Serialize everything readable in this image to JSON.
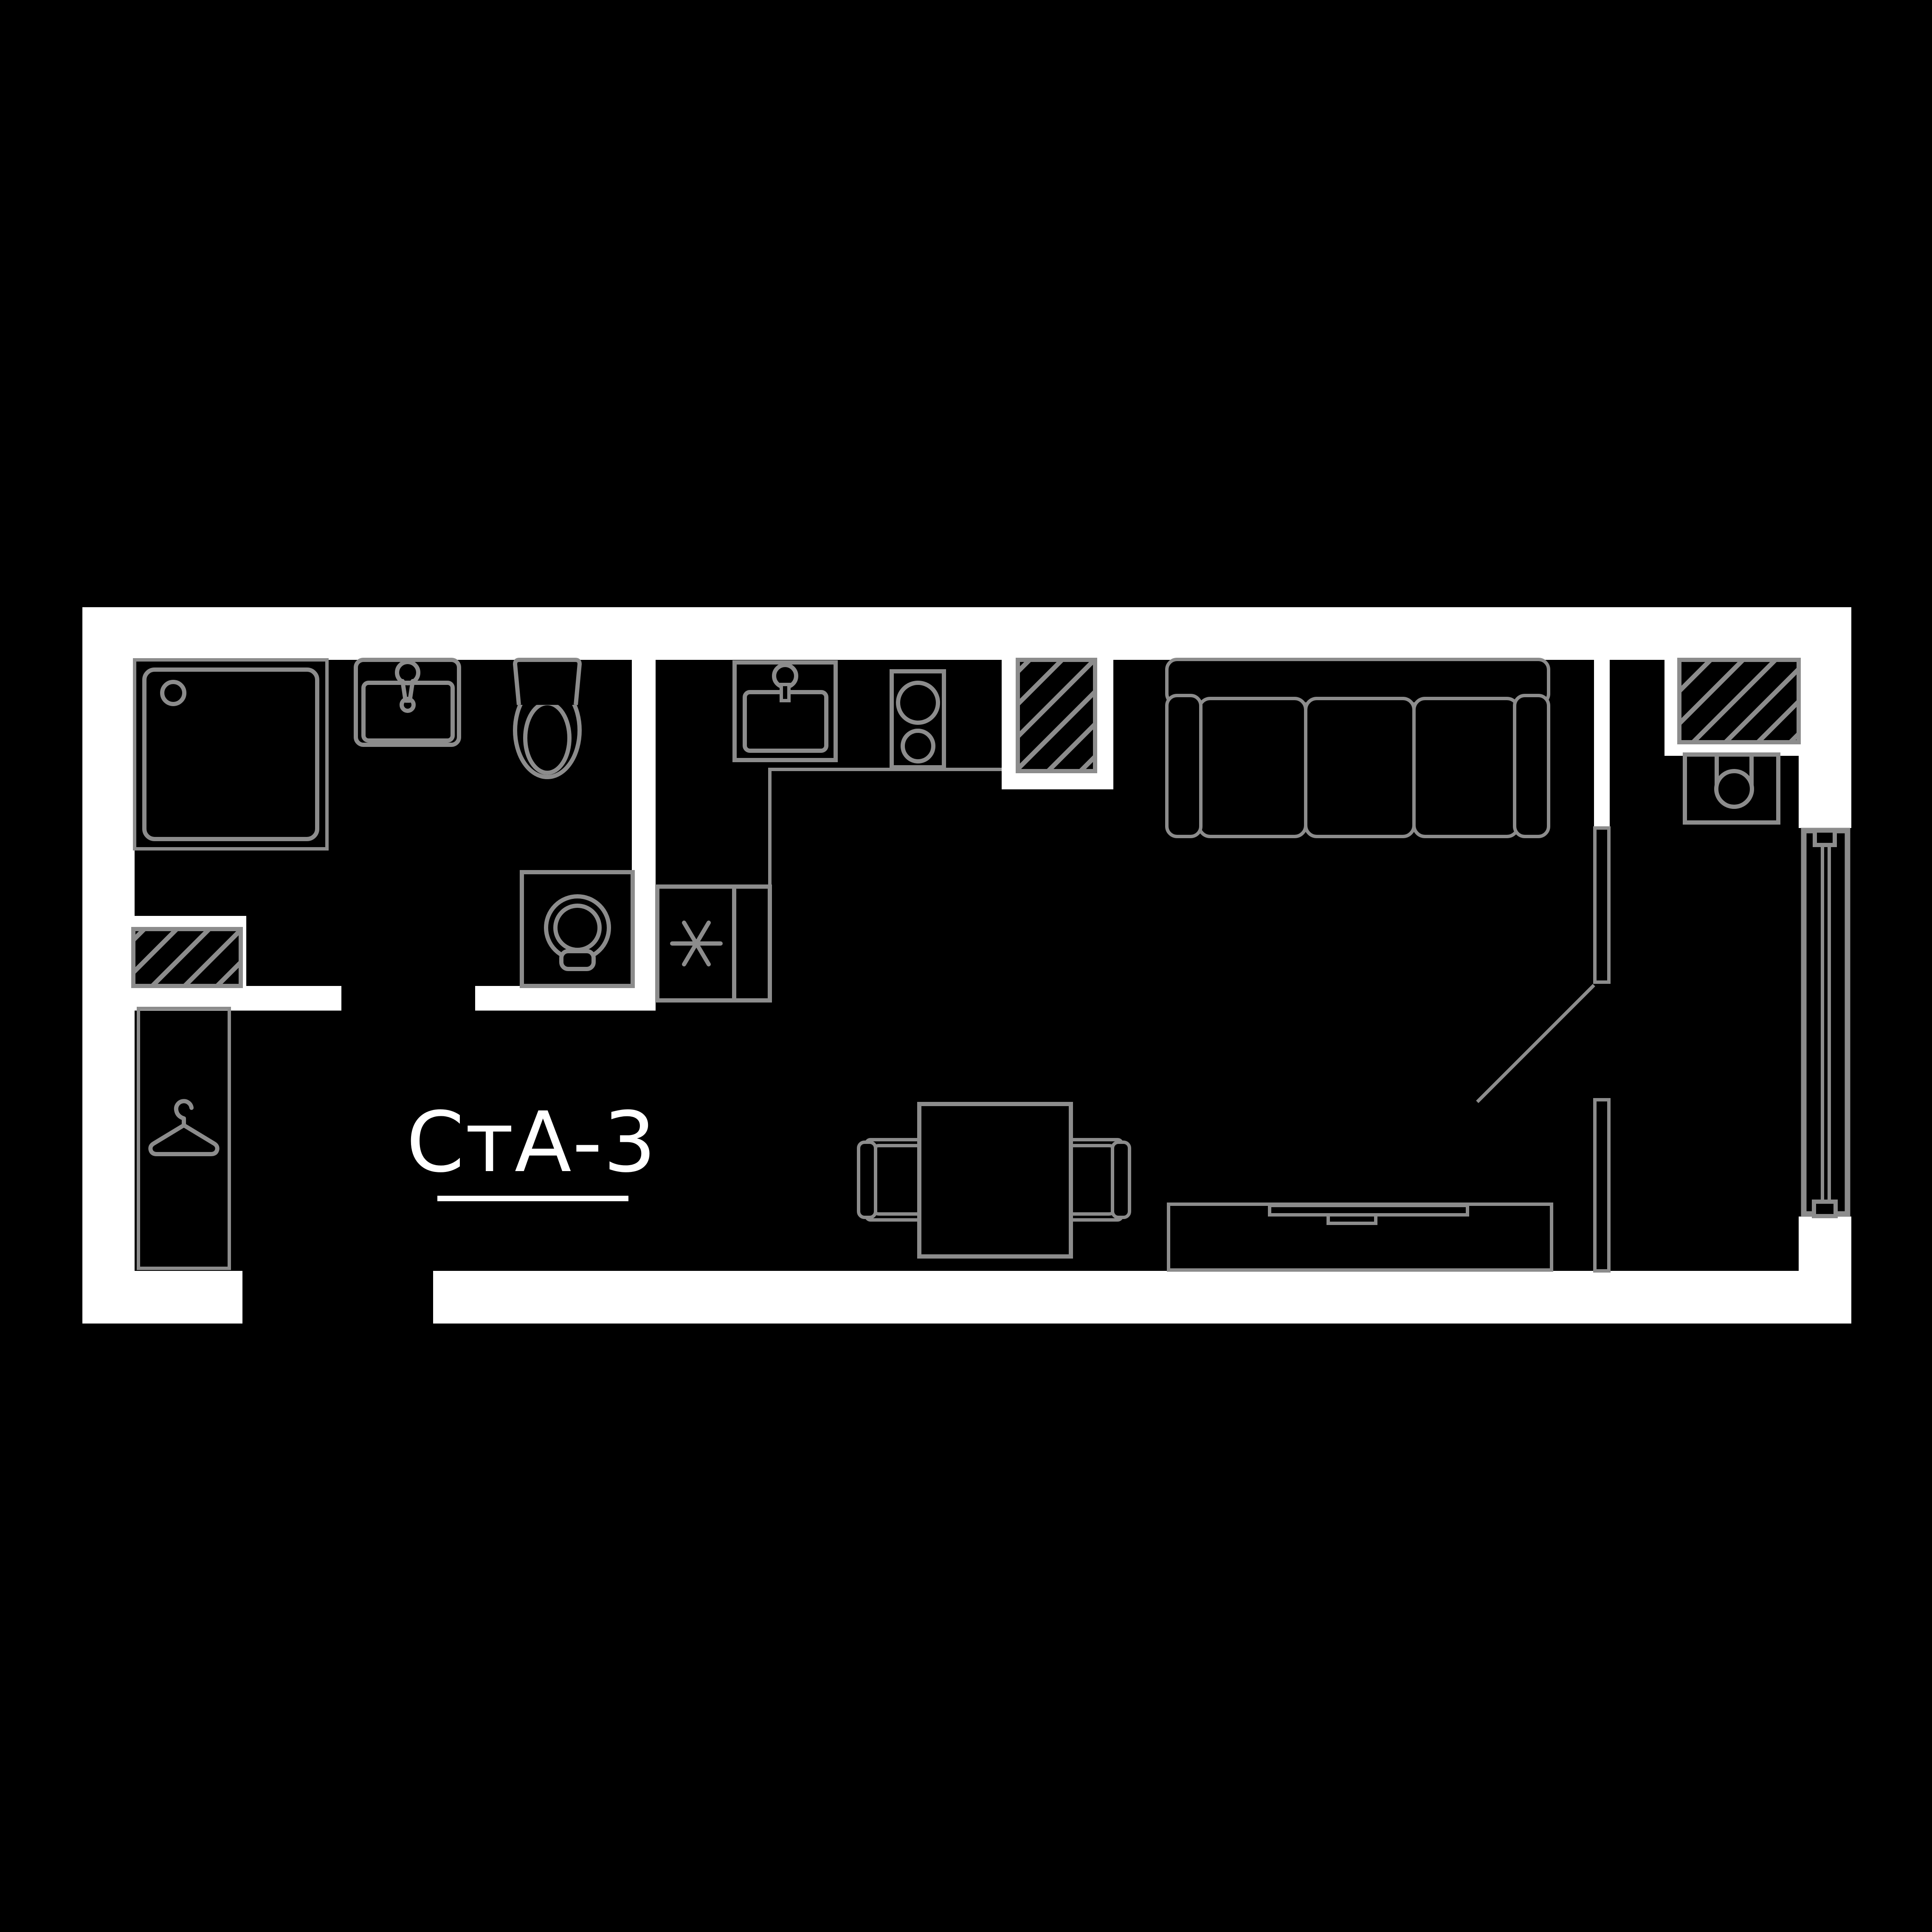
{
  "plan": {
    "title": "СтА-3",
    "colors": {
      "background": "#000000",
      "wall": "#ffffff",
      "line": "#8c8c8c",
      "text": "#ffffff"
    },
    "legend": {
      "bathroom": [
        "shower",
        "washbasin",
        "toilet",
        "washing-machine",
        "ventilation-shaft"
      ],
      "kitchen": [
        "kitchen-sink",
        "cooktop",
        "refrigerator",
        "counter",
        "ventilation-shaft"
      ],
      "living_room": [
        "sofa",
        "dining-table",
        "chair",
        "chair",
        "tv-stand",
        "tv"
      ],
      "hallway": [
        "wardrobe",
        "hanger"
      ],
      "balcony": [
        "balcony-sink",
        "ventilation-shaft",
        "window",
        "glazed-partition",
        "door-swing"
      ]
    }
  }
}
